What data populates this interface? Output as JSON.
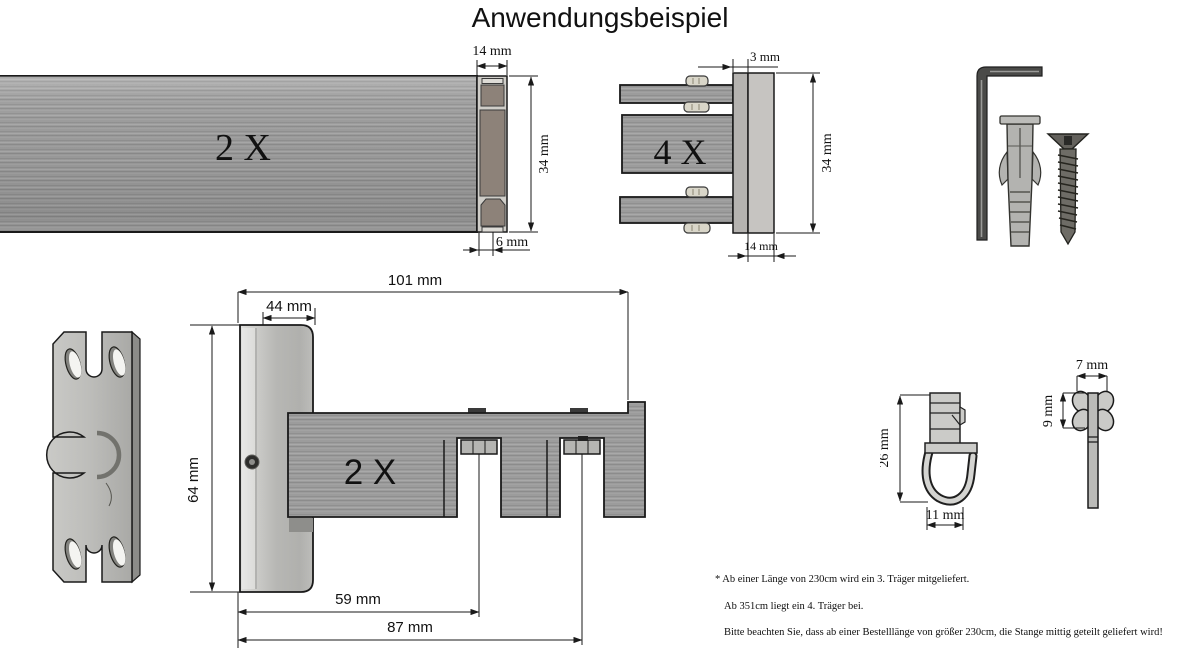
{
  "title": "Anwendungsbeispiel",
  "colors": {
    "background": "#ffffff",
    "outline": "#1a1a1a",
    "metal_gray": "#9c9c9c",
    "plate_gray": "#c6c6c3",
    "cap_bronze": "#8d8279"
  },
  "rod_profile": {
    "quantity": "2 X",
    "dim_cap_width": "14 mm",
    "dim_height": "34 mm",
    "dim_stem": "6 mm"
  },
  "end_connector": {
    "quantity": "4 X",
    "dim_plate_depth": "3 mm",
    "dim_height": "34 mm",
    "dim_width": "14 mm"
  },
  "wall_bracket": {
    "quantity": "2 X",
    "dim_total_length": "101 mm",
    "dim_base_width": "44 mm",
    "dim_height": "64 mm",
    "dim_first_slot": "59 mm",
    "dim_second_slot": "87 mm"
  },
  "glider_hook": {
    "dim_height": "26 mm",
    "dim_width": "11 mm"
  },
  "glider_top_view": {
    "dim_width": "7 mm",
    "dim_height": "9 mm"
  },
  "notes": {
    "line1": "* Ab einer Länge von 230cm wird ein 3. Träger mitgeliefert.",
    "line2": "Ab 351cm liegt ein 4. Träger bei.",
    "line3": "Bitte beachten Sie, dass ab einer Bestelllänge von größer 230cm, die Stange mittig geteilt geliefert wird!"
  }
}
